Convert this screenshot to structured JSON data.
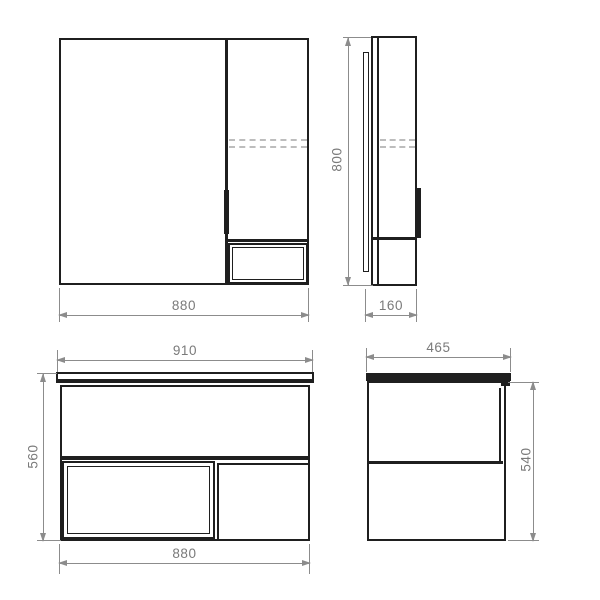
{
  "drawing": {
    "type": "furniture technical drawing",
    "views": {
      "mirror_cabinet_front": {
        "width": "880"
      },
      "mirror_cabinet_side": {
        "height": "800",
        "depth": "160"
      },
      "vanity_front": {
        "countertop_width": "910",
        "height": "560",
        "cabinet_width": "880"
      },
      "vanity_side": {
        "countertop_depth": "465",
        "cabinet_height": "540"
      }
    },
    "colors": {
      "outline": "#1f1f1f",
      "dimension_line": "#8c8c8c",
      "dimension_text": "#7a7a7a",
      "hidden_line": "#bdbdbd",
      "background": "#ffffff"
    }
  }
}
